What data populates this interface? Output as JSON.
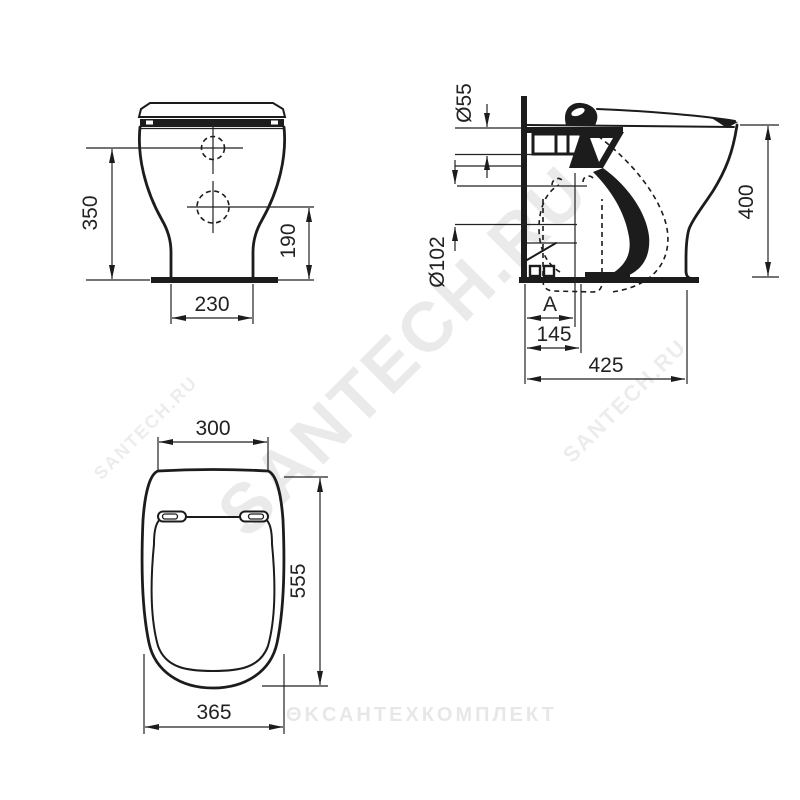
{
  "page": {
    "background": "#ffffff",
    "line_color": "#1c1c1c",
    "description_kind": "toilet-pan-dimensional-drawing"
  },
  "watermarks": {
    "diagonal_main": "SANTECH.RU",
    "diagonal_left": "SANTECH.RU",
    "diagonal_right": "SANTECH.RU",
    "bottom_logo": "ΘΚ",
    "bottom_text": "САНТЕХКОМПЛЕКТ"
  },
  "views": {
    "front": {
      "dims": {
        "height_to_upper_hole": "350",
        "height_to_lower_hole": "190",
        "base_width": "230"
      }
    },
    "side": {
      "dims": {
        "inlet_diameter": "Ø55",
        "outlet_diameter": "Ø102",
        "seat_height": "400",
        "outlet_offset": "A",
        "outlet_distance": "145",
        "depth": "425"
      }
    },
    "top": {
      "dims": {
        "back_width": "300",
        "overall_depth": "555",
        "front_width": "365"
      }
    }
  }
}
